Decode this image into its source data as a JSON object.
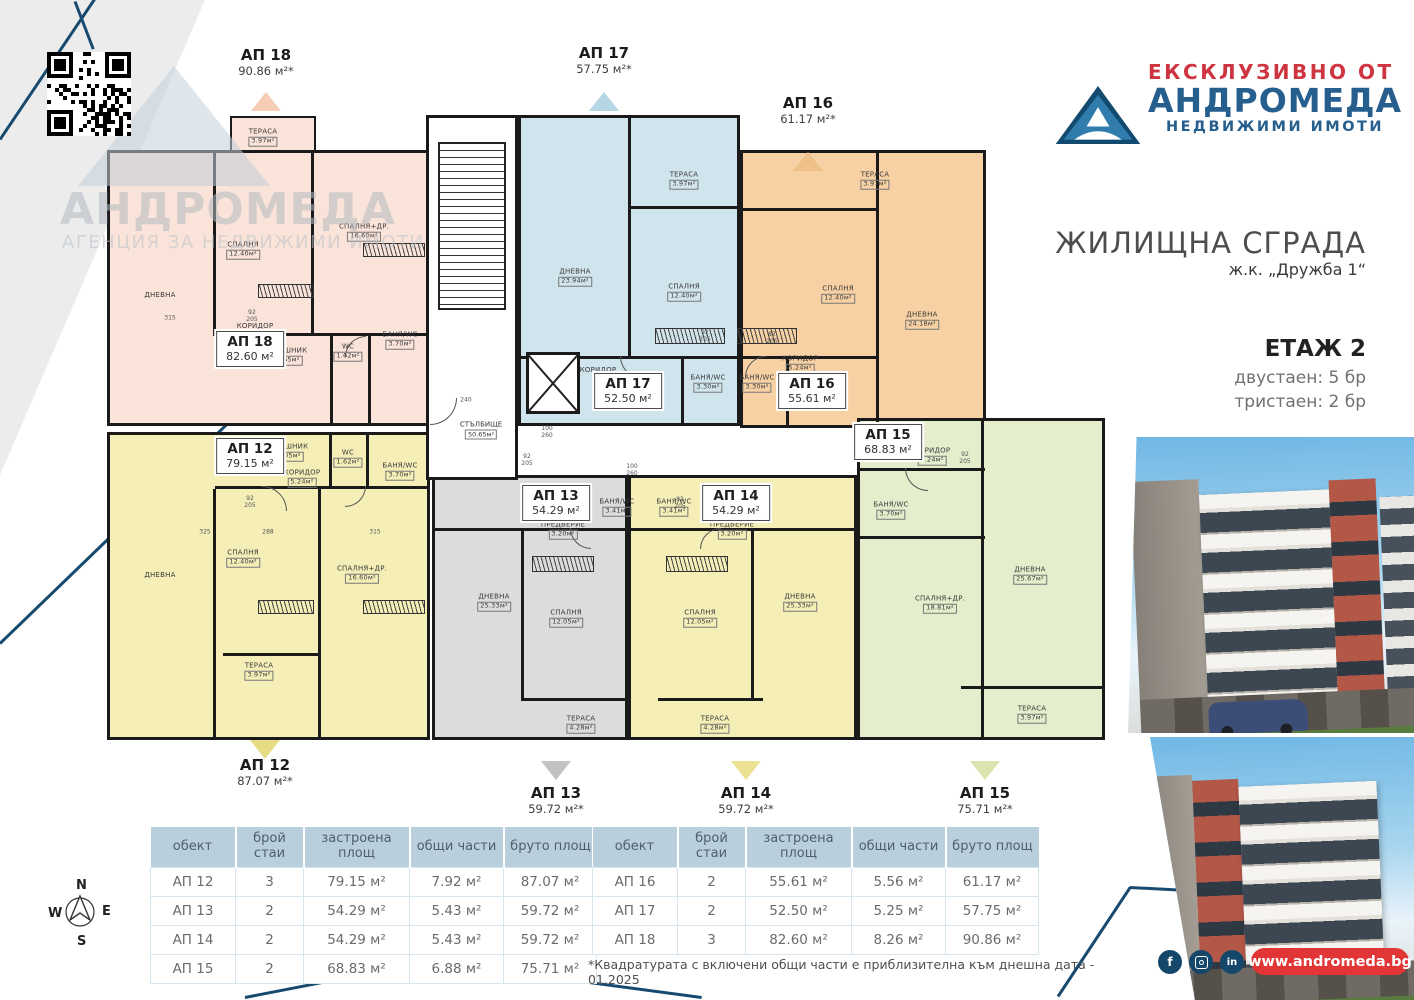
{
  "branding": {
    "exclusive_label": "ЕКСКЛУЗИВНО ОТ",
    "agency_name": "АНДРОМЕДА",
    "agency_subtitle": "НЕДВИЖИМИ ИМОТИ",
    "watermark_name": "АНДРОМЕДА",
    "watermark_subtitle": "АГЕНЦИЯ ЗА НЕДВИЖИМИ ИМОТИ",
    "website": "www.andromeda.bg",
    "colors": {
      "navy": "#15476b",
      "red": "#cf3540",
      "pill_red": "#e23535",
      "table_header": "#b9cfdc"
    }
  },
  "header": {
    "building_title": "ЖИЛИЩНА СГРАДА",
    "location": "ж.к. „Дружба 1“",
    "floor_label": "ЕТАЖ 2",
    "unit_counts": [
      "двустаен: 5 бр",
      "тристаен: 2 бр"
    ]
  },
  "floor_plan": {
    "compass": {
      "n": "N",
      "e": "E",
      "s": "S",
      "w": "W"
    },
    "stairwell": {
      "label": "СТЪЛБИЩЕ",
      "area": "50.65м²",
      "x": 481,
      "y": 430,
      "core": [
        426,
        115,
        92,
        365
      ],
      "steps": [
        438,
        142,
        68,
        168
      ],
      "elevator": [
        526,
        352,
        54,
        62
      ]
    },
    "apartments": [
      {
        "key": "ap18",
        "title": "АП 18",
        "inner_area": "82.60 м²",
        "outer_area": "90.86 м²*",
        "fill": "#fae3d8",
        "rect": [
          107,
          150,
          323,
          276
        ],
        "bumps": [
          [
            230,
            116,
            86,
            36
          ]
        ],
        "inner": {
          "x": 250,
          "y": 349
        },
        "outer": {
          "x": 266,
          "y": 46
        },
        "marker": {
          "x": 266,
          "y": 92,
          "dir": "up",
          "color": "#f5cdb4"
        },
        "dividers": [
          [
            213,
            150,
            3,
            186
          ],
          [
            311,
            150,
            3,
            186
          ],
          [
            215,
            333,
            215,
            3
          ],
          [
            330,
            336,
            3,
            89
          ],
          [
            368,
            336,
            3,
            89
          ]
        ],
        "rooms": [
          {
            "label": "ТЕРАСА",
            "area": "3.97м²",
            "x": 263,
            "y": 137
          },
          {
            "label": "ДНЕВНА",
            "x": 160,
            "y": 295
          },
          {
            "label": "СПАЛНЯ",
            "area": "12.40м²",
            "x": 243,
            "y": 250
          },
          {
            "label": "СПАЛНЯ+ДР.",
            "area": "16.60м²",
            "x": 364,
            "y": 232
          },
          {
            "label": "КОРИДОР",
            "x": 255,
            "y": 326
          },
          {
            "label": "ДРЕШНИК",
            "area": "1.05м²",
            "x": 288,
            "y": 356
          },
          {
            "label": "WC",
            "area": "1.62м²",
            "x": 348,
            "y": 352
          },
          {
            "label": "БАНЯ/WC",
            "area": "3.70м²",
            "x": 400,
            "y": 340
          }
        ]
      },
      {
        "key": "ap17",
        "title": "АП 17",
        "inner_area": "52.50 м²",
        "outer_area": "57.75 м²*",
        "fill": "#cfe4ec",
        "rect": [
          518,
          115,
          222,
          311
        ],
        "inner": {
          "x": 628,
          "y": 391
        },
        "outer": {
          "x": 604,
          "y": 44
        },
        "marker": {
          "x": 604,
          "y": 92,
          "dir": "up",
          "color": "#b5d6e2"
        },
        "dividers": [
          [
            628,
            115,
            3,
            243
          ],
          [
            630,
            206,
            110,
            3
          ],
          [
            518,
            356,
            222,
            3
          ],
          [
            681,
            356,
            3,
            70
          ]
        ],
        "rooms": [
          {
            "label": "ДНЕВНА",
            "area": "23.94м²",
            "x": 575,
            "y": 277
          },
          {
            "label": "ТЕРАСА",
            "area": "3.97м²",
            "x": 684,
            "y": 180
          },
          {
            "label": "СПАЛНЯ",
            "area": "12.40м²",
            "x": 684,
            "y": 292
          },
          {
            "label": "КОРИДОР",
            "x": 598,
            "y": 370
          },
          {
            "label": "БАНЯ/WC",
            "area": "3.30м²",
            "x": 708,
            "y": 383
          }
        ]
      },
      {
        "key": "ap16",
        "title": "АП 16",
        "inner_area": "55.61 м²",
        "outer_area": "61.17 м²*",
        "fill": "#f7d1a3",
        "rect": [
          740,
          150,
          246,
          278
        ],
        "inner": {
          "x": 812,
          "y": 391
        },
        "outer": {
          "x": 808,
          "y": 94
        },
        "marker": {
          "x": 808,
          "y": 152,
          "dir": "up",
          "color": "#efc188"
        },
        "dividers": [
          [
            876,
            150,
            3,
            278
          ],
          [
            740,
            208,
            138,
            3
          ],
          [
            740,
            356,
            138,
            3
          ],
          [
            786,
            356,
            3,
            72
          ]
        ],
        "rooms": [
          {
            "label": "ТЕРАСА",
            "area": "3.97м²",
            "x": 875,
            "y": 180
          },
          {
            "label": "СПАЛНЯ",
            "area": "12.40м²",
            "x": 838,
            "y": 294
          },
          {
            "label": "ДНЕВНА",
            "area": "24.18м²",
            "x": 922,
            "y": 320
          },
          {
            "label": "КОРИДОР",
            "area": "5.24м²",
            "x": 800,
            "y": 364
          },
          {
            "label": "БАНЯ/WC",
            "area": "3.30м²",
            "x": 757,
            "y": 383
          }
        ]
      },
      {
        "key": "ap12",
        "title": "АП 12",
        "inner_area": "79.15 м²",
        "outer_area": "87.07 м²*",
        "fill": "#f5efb7",
        "rect": [
          107,
          432,
          323,
          308
        ],
        "inner": {
          "x": 250,
          "y": 456
        },
        "outer": {
          "x": 265,
          "y": 756
        },
        "marker": {
          "x": 265,
          "y": 740,
          "dir": "down",
          "color": "#e6dc85"
        },
        "dividers": [
          [
            215,
            486,
            215,
            3
          ],
          [
            213,
            489,
            3,
            251
          ],
          [
            318,
            489,
            3,
            251
          ],
          [
            329,
            432,
            3,
            56
          ],
          [
            366,
            432,
            3,
            56
          ],
          [
            223,
            653,
            98,
            3
          ]
        ],
        "rooms": [
          {
            "label": "КОРИДОР",
            "area": "5.24м²",
            "x": 302,
            "y": 478
          },
          {
            "label": "ДРЕШНИК",
            "area": "1.05м²",
            "x": 289,
            "y": 452
          },
          {
            "label": "WC",
            "area": "1.62м²",
            "x": 348,
            "y": 458
          },
          {
            "label": "БАНЯ/WC",
            "area": "3.70м²",
            "x": 400,
            "y": 471
          },
          {
            "label": "СПАЛНЯ",
            "area": "12.40м²",
            "x": 243,
            "y": 558
          },
          {
            "label": "СПАЛНЯ+ДР.",
            "area": "16.60м²",
            "x": 362,
            "y": 574
          },
          {
            "label": "ТЕРАСА",
            "area": "3.97м²",
            "x": 259,
            "y": 671
          },
          {
            "label": "ДНЕВНА",
            "x": 160,
            "y": 575
          }
        ]
      },
      {
        "key": "ap13",
        "title": "АП 13",
        "inner_area": "54.29 м²",
        "outer_area": "59.72 м²*",
        "fill": "#dcdcdc",
        "rect": [
          432,
          475,
          196,
          265
        ],
        "inner": {
          "x": 556,
          "y": 503
        },
        "outer": {
          "x": 556,
          "y": 784
        },
        "marker": {
          "x": 556,
          "y": 761,
          "dir": "down",
          "color": "#c2c2c2"
        },
        "dividers": [
          [
            432,
            528,
            196,
            3
          ],
          [
            521,
            531,
            3,
            170
          ],
          [
            523,
            698,
            105,
            3
          ]
        ],
        "rooms": [
          {
            "label": "БАНЯ/WC",
            "area": "3.41м²",
            "x": 617,
            "y": 507
          },
          {
            "label": "ПРЕДВЕРИЕ",
            "area": "3.20м²",
            "x": 563,
            "y": 530
          },
          {
            "label": "ДНЕВНА",
            "area": "25.33м²",
            "x": 494,
            "y": 602
          },
          {
            "label": "СПАЛНЯ",
            "area": "12.05м²",
            "x": 566,
            "y": 618
          },
          {
            "label": "ТЕРАСА",
            "area": "4.28м²",
            "x": 581,
            "y": 724
          }
        ]
      },
      {
        "key": "ap14",
        "title": "АП 14",
        "inner_area": "54.29 м²",
        "outer_area": "59.72 м²*",
        "fill": "#f5efb7",
        "rect": [
          628,
          475,
          229,
          265
        ],
        "inner": {
          "x": 736,
          "y": 503
        },
        "outer": {
          "x": 746,
          "y": 784
        },
        "marker": {
          "x": 746,
          "y": 761,
          "dir": "down",
          "color": "#ece293"
        },
        "dividers": [
          [
            628,
            528,
            229,
            3
          ],
          [
            751,
            531,
            3,
            170
          ],
          [
            658,
            698,
            105,
            3
          ]
        ],
        "rooms": [
          {
            "label": "БАНЯ/WC",
            "area": "3.41м²",
            "x": 674,
            "y": 507
          },
          {
            "label": "ПРЕДВЕРИЕ",
            "area": "3.20м²",
            "x": 732,
            "y": 530
          },
          {
            "label": "СПАЛНЯ",
            "area": "12.05м²",
            "x": 700,
            "y": 618
          },
          {
            "label": "ДНЕВНА",
            "area": "25.33м²",
            "x": 800,
            "y": 602
          },
          {
            "label": "ТЕРАСА",
            "area": "4.28м²",
            "x": 715,
            "y": 724
          }
        ]
      },
      {
        "key": "ap15",
        "title": "АП 15",
        "inner_area": "68.83 м²",
        "outer_area": "75.71 м²*",
        "fill": "#e4edcc",
        "rect": [
          857,
          418,
          248,
          322
        ],
        "inner": {
          "x": 888,
          "y": 442
        },
        "outer": {
          "x": 985,
          "y": 784
        },
        "marker": {
          "x": 985,
          "y": 761,
          "dir": "down",
          "color": "#d9e4ae"
        },
        "dividers": [
          [
            857,
            468,
            128,
            3
          ],
          [
            857,
            536,
            128,
            3
          ],
          [
            981,
            418,
            3,
            121
          ],
          [
            981,
            536,
            3,
            204
          ],
          [
            961,
            686,
            144,
            3
          ]
        ],
        "rooms": [
          {
            "label": "КОРИДОР",
            "area": "5.24м²",
            "x": 932,
            "y": 456
          },
          {
            "label": "БАНЯ/WC",
            "area": "3.70м²",
            "x": 891,
            "y": 510
          },
          {
            "label": "СПАЛНЯ+ДР.",
            "area": "18.81м²",
            "x": 940,
            "y": 604
          },
          {
            "label": "ДНЕВНА",
            "area": "25.67м²",
            "x": 1030,
            "y": 575
          },
          {
            "label": "ТЕРАСА",
            "area": "3.97м²",
            "x": 1032,
            "y": 714
          }
        ]
      }
    ],
    "hatches": [
      [
        363,
        243,
        62,
        14
      ],
      [
        258,
        284,
        56,
        14
      ],
      [
        655,
        328,
        70,
        16
      ],
      [
        737,
        328,
        60,
        16
      ],
      [
        258,
        600,
        56,
        14
      ],
      [
        363,
        600,
        62,
        14
      ],
      [
        532,
        556,
        62,
        16
      ],
      [
        666,
        556,
        62,
        16
      ]
    ],
    "door_arcs": [
      [
        262,
        336,
        24,
        0
      ],
      [
        345,
        336,
        20,
        90
      ],
      [
        620,
        356,
        22,
        0
      ],
      [
        745,
        356,
        20,
        90
      ],
      [
        262,
        486,
        24,
        180
      ],
      [
        345,
        486,
        20,
        270
      ],
      [
        905,
        468,
        22,
        0
      ],
      [
        570,
        528,
        20,
        0
      ],
      [
        700,
        528,
        20,
        90
      ],
      [
        430,
        398,
        26,
        270
      ]
    ],
    "dims": [
      {
        "t": "92\n205",
        "x": 252,
        "y": 316
      },
      {
        "t": "100\n260",
        "x": 547,
        "y": 432
      },
      {
        "t": "92\n205",
        "x": 527,
        "y": 460
      },
      {
        "t": "240",
        "x": 466,
        "y": 400
      },
      {
        "t": "92\n205",
        "x": 705,
        "y": 336
      },
      {
        "t": "82\n205",
        "x": 772,
        "y": 338
      },
      {
        "t": "92\n205",
        "x": 965,
        "y": 458
      },
      {
        "t": "100\n260",
        "x": 632,
        "y": 470
      },
      {
        "t": "92\n205",
        "x": 250,
        "y": 502
      },
      {
        "t": "82\n205",
        "x": 680,
        "y": 503
      },
      {
        "t": "315",
        "x": 170,
        "y": 318
      },
      {
        "t": "325",
        "x": 205,
        "y": 532
      },
      {
        "t": "288",
        "x": 268,
        "y": 532
      },
      {
        "t": "315",
        "x": 375,
        "y": 532
      }
    ]
  },
  "tables": [
    {
      "columns": [
        "обект",
        "брой стаи",
        "застроена площ",
        "общи части",
        "бруто площ"
      ],
      "rows": [
        [
          "АП 12",
          "3",
          "79.15 м²",
          "7.92 м²",
          "87.07 м²"
        ],
        [
          "АП 13",
          "2",
          "54.29 м²",
          "5.43 м²",
          "59.72 м²"
        ],
        [
          "АП 14",
          "2",
          "54.29 м²",
          "5.43 м²",
          "59.72 м²"
        ],
        [
          "АП 15",
          "2",
          "68.83 м²",
          "6.88 м²",
          "75.71 м²"
        ]
      ]
    },
    {
      "columns": [
        "обект",
        "брой стаи",
        "застроена площ",
        "общи части",
        "бруто площ"
      ],
      "rows": [
        [
          "АП 16",
          "2",
          "55.61 м²",
          "5.56 м²",
          "61.17 м²"
        ],
        [
          "АП 17",
          "2",
          "52.50 м²",
          "5.25 м²",
          "57.75 м²"
        ],
        [
          "АП 18",
          "3",
          "82.60 м²",
          "8.26 м²",
          "90.86 м²"
        ]
      ]
    }
  ],
  "footnote": "*Квадратурата с включени общи части е приблизителна към днешна дата - 01.2025",
  "social": [
    "facebook",
    "instagram",
    "linkedin"
  ]
}
